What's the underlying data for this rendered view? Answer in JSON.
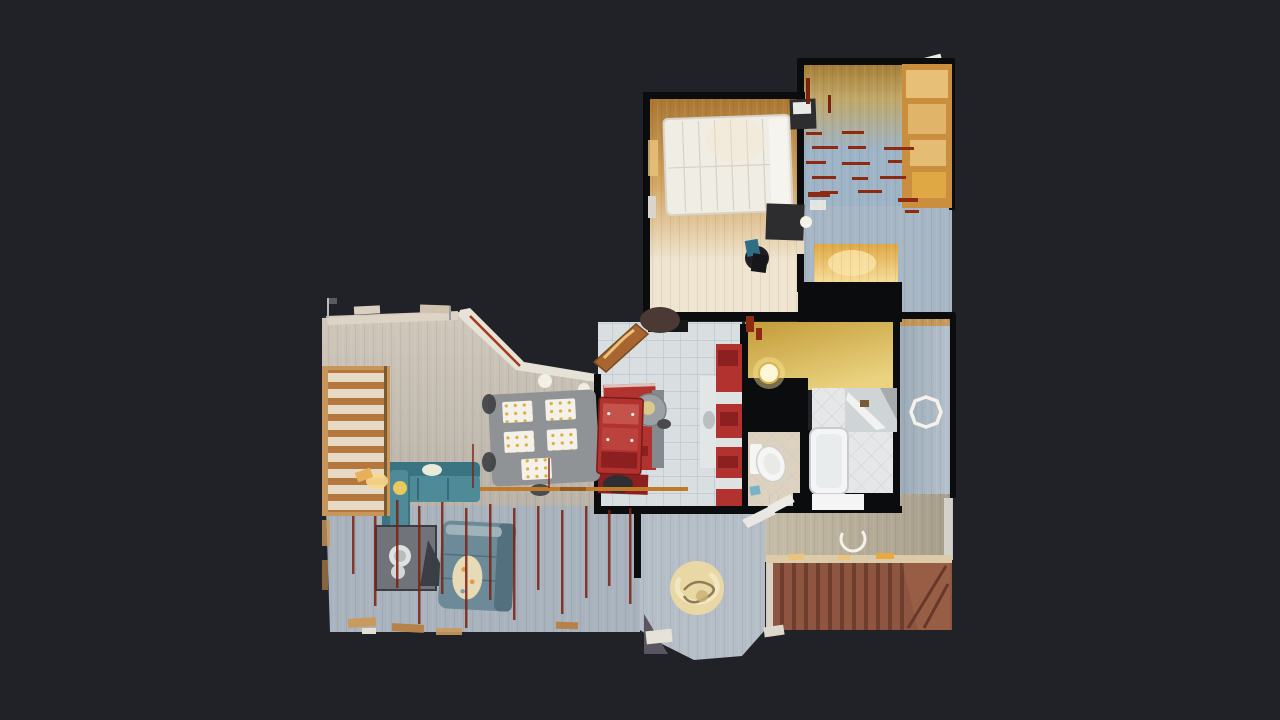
{
  "scene": {
    "description": "Top-down 3D dollhouse scan of a house floor plan on a dark viewer canvas",
    "background": "#212227"
  },
  "colors": {
    "bg": "#212227",
    "wall": "#0b0c0e",
    "master_top": "#a8742f",
    "master_mid": "#d2a561",
    "master_bot": "#efe4cf",
    "kids_top": "#a37a30",
    "kids_mid": "#c1a768",
    "kids_blue": "#9db3c6",
    "landing_blue": "#a6b6c4",
    "closet_amber": "#dfa845",
    "closet_glow": "#f9e3a4",
    "corridor_a": "#9aa9b6",
    "corridor_b": "#b6c2cc",
    "hall_yellow_a": "#c39b38",
    "hall_yellow_b": "#ead27f",
    "dining_a": "#cfc7ba",
    "dining_b": "#bab3a9",
    "kitchen_tile": "#d9dee1",
    "tile_line": "#b9c3c9",
    "living_blue": "#a9b3bd",
    "foyer_gray": "#b5bec7",
    "hallway_a": "#c6bda8",
    "hallway_b": "#a69d8a",
    "stair_base": "#8e5540",
    "stair_riser": "#67382a",
    "stair_tread": "#aa6c50",
    "lstair_wood": "#b5773c",
    "lstair_cream": "#eae3d1",
    "lstair_frame": "#c8955a",
    "red_cab": "#b23230",
    "red_cab_dark": "#8c1f1f",
    "red_dash": "#8f2a12",
    "red_streak": "#7c2010",
    "teal": "#4e8a97",
    "teal_dark": "#3a7482",
    "couch_gray": "#6d8a98",
    "couch_gray_dark": "#52707e",
    "table_gray": "#8f9396",
    "placemat": "#f3f1ea",
    "placemat_dot": "#dcae3c",
    "bed_white": "#f0ede5",
    "bed_line": "#d8d2c5",
    "dark_furn": "#2d2c2e",
    "wood_orange": "#c98f3f",
    "wood_light": "#eac47c",
    "bath_tile": "#e6e7e8",
    "wc_tile": "#ddd2bf",
    "grout": "#c2c6c9",
    "white_fix": "#f4f5f4",
    "rail_orange": "#c07a28",
    "glow": "#f7d98e",
    "light_white": "#f5f2ea",
    "circle_cream": "#e9d8a6",
    "circle_shadow": "#8f7d55",
    "shadow_gray": "#5a5560"
  }
}
